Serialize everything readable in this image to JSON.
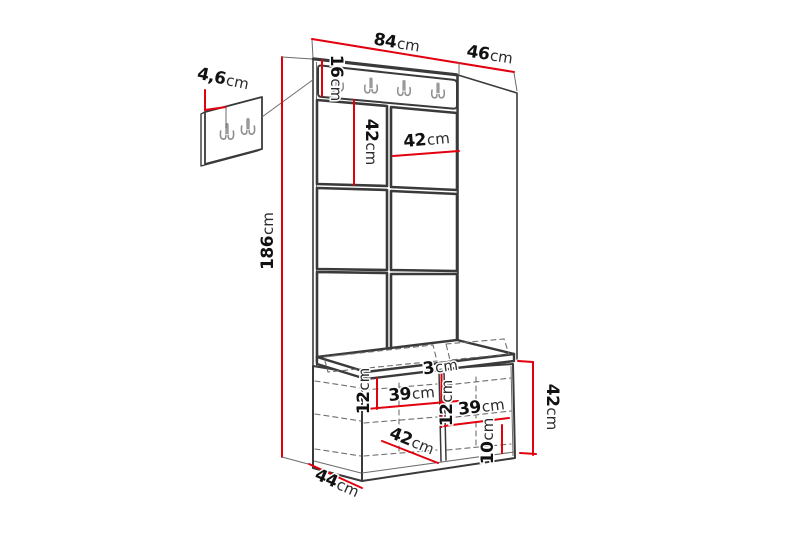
{
  "diagram": {
    "name": "hallway-furniture-dimension-diagram",
    "background": "#ffffff",
    "accent_color": "#e2000f",
    "outline_color": "#3a3a3a",
    "dims": {
      "width": {
        "v": "84",
        "u": "cm"
      },
      "depth": {
        "v": "46",
        "u": "cm"
      },
      "rail_height": {
        "v": "16",
        "u": "cm"
      },
      "hook_inset": {
        "v": "4,6",
        "u": "cm"
      },
      "panel_height": {
        "v": "42",
        "u": "cm"
      },
      "panel_width": {
        "v": "42",
        "u": "cm"
      },
      "total_height": {
        "v": "186",
        "u": "cm"
      },
      "divider_thickness": {
        "v": "3",
        "u": "cm"
      },
      "shelf_gap_left": {
        "v": "12",
        "u": "cm"
      },
      "compartment_width_left": {
        "v": "39",
        "u": "cm"
      },
      "shelf_gap_mid": {
        "v": "12",
        "u": "cm"
      },
      "compartment_width_right": {
        "v": "39",
        "u": "cm"
      },
      "plinth_height": {
        "v": "10",
        "u": "cm"
      },
      "bench_inner_width": {
        "v": "42",
        "u": "cm"
      },
      "bench_depth": {
        "v": "44",
        "u": "cm"
      },
      "bench_height": {
        "v": "42",
        "u": "cm"
      }
    }
  }
}
